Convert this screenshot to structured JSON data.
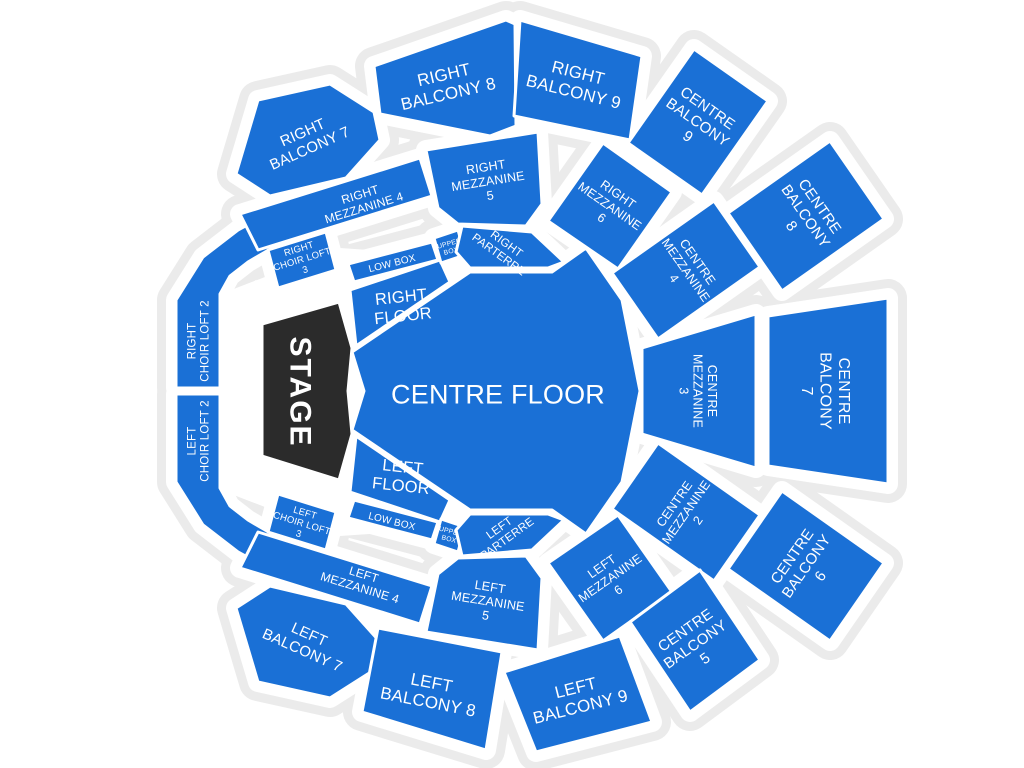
{
  "map": {
    "width": 1024,
    "height": 768,
    "background": "#ffffff",
    "outline_color": "#ebebeb",
    "gap_color": "#ffffff",
    "section_fill": "#1a70d6",
    "stage_fill": "#2b2b2b",
    "label_color": "#ffffff"
  },
  "spacers": [
    {
      "points": "226,292 340,248 458,256 458,528 340,536 226,492"
    }
  ],
  "sections": [
    {
      "id": "centre-floor",
      "kind": "seating",
      "label": [
        "CENTRE FLOOR"
      ],
      "points": "352,352 470,272 552,272 586,248 622,300 640,391 622,482 586,534 552,510 470,510 352,430 364,391",
      "label_x": 498,
      "label_y": 394,
      "label_rotate": 0,
      "font_size": 27
    },
    {
      "id": "right-floor",
      "kind": "seating",
      "label": [
        "RIGHT",
        "FLOOR"
      ],
      "points": "350,290 440,260 450,282 356,346",
      "label_x": 402,
      "label_y": 306,
      "label_rotate": -6,
      "font_size": 16.5
    },
    {
      "id": "left-floor",
      "kind": "seating",
      "label": [
        "LEFT",
        "FLOOR"
      ],
      "points": "350,492 440,522 450,500 356,436",
      "label_x": 402,
      "label_y": 476,
      "label_rotate": 6,
      "font_size": 16.5
    },
    {
      "id": "low-box-right",
      "kind": "seating",
      "label": [
        "LOW BOX"
      ],
      "points": "348,264 432,242 438,260 354,282",
      "label_x": 392,
      "label_y": 263,
      "label_rotate": -14,
      "font_size": 10
    },
    {
      "id": "low-box-left",
      "kind": "seating",
      "label": [
        "LOW BOX"
      ],
      "points": "348,518 432,540 438,522 354,500",
      "label_x": 392,
      "label_y": 521,
      "label_rotate": 14,
      "font_size": 10
    },
    {
      "id": "upper-box-right",
      "kind": "seating",
      "label": [
        "UPPER",
        "BOX"
      ],
      "points": "434,238 458,230 465,255 441,263",
      "label_x": 450,
      "label_y": 247,
      "label_rotate": -15,
      "font_size": 6.8
    },
    {
      "id": "upper-box-left",
      "kind": "seating",
      "label": [
        "UPPER",
        "BOX"
      ],
      "points": "434,544 458,552 465,527 441,519",
      "label_x": 450,
      "label_y": 535,
      "label_rotate": 15,
      "font_size": 6.8
    },
    {
      "id": "right-parterre",
      "kind": "seating",
      "label": [
        "RIGHT",
        "PARTERRE"
      ],
      "points": "462,226 532,232 564,262 548,268 470,268 456,252",
      "label_x": 503,
      "label_y": 249,
      "label_rotate": 36,
      "font_size": 11.5
    },
    {
      "id": "left-parterre",
      "kind": "seating",
      "label": [
        "LEFT",
        "PARTERRE"
      ],
      "points": "462,556 532,550 564,520 548,514 470,514 456,530",
      "label_x": 503,
      "label_y": 533,
      "label_rotate": -36,
      "font_size": 11.5
    },
    {
      "id": "right-choir-loft-2",
      "kind": "seating",
      "label": [
        "RIGHT",
        "CHOIR LOFT 2"
      ],
      "points": "176,300 203,257 238,230 264,216 272,248 248,262 230,276 220,294 220,388 176,388",
      "label_x": 198,
      "label_y": 341,
      "label_rotate": -90,
      "font_size": 11.5
    },
    {
      "id": "left-choir-loft-2",
      "kind": "seating",
      "label": [
        "LEFT",
        "CHOIR LOFT 2"
      ],
      "points": "176,482 203,525 238,552 264,566 272,534 248,520 230,506 220,488 220,394 176,394",
      "label_x": 198,
      "label_y": 441,
      "label_rotate": -90,
      "font_size": 11.5
    },
    {
      "id": "right-choir-loft-3",
      "kind": "seating",
      "label": [
        "RIGHT",
        "CHOIR LOFT",
        "3"
      ],
      "points": "268,250 326,232 336,270 278,288",
      "label_x": 302,
      "label_y": 259,
      "label_rotate": -17,
      "font_size": 9.5
    },
    {
      "id": "left-choir-loft-3",
      "kind": "seating",
      "label": [
        "LEFT",
        "CHOIR LOFT",
        "3"
      ],
      "points": "268,532 326,550 336,512 278,494",
      "label_x": 302,
      "label_y": 523,
      "label_rotate": 17,
      "font_size": 9.5
    },
    {
      "id": "right-mezzanine-4",
      "kind": "seating",
      "label": [
        "RIGHT",
        "MEZZANINE 4"
      ],
      "points": "240,214 420,158 432,196 258,250",
      "label_x": 362,
      "label_y": 201,
      "label_rotate": -17,
      "font_size": 12
    },
    {
      "id": "left-mezzanine-4",
      "kind": "seating",
      "label": [
        "LEFT",
        "MEZZANINE 4"
      ],
      "points": "240,568 420,624 432,586 258,532",
      "label_x": 362,
      "label_y": 581,
      "label_rotate": 17,
      "font_size": 12
    },
    {
      "id": "right-mezzanine-5",
      "kind": "seating",
      "label": [
        "RIGHT",
        "MEZZANINE",
        "5"
      ],
      "points": "426,150 538,132 542,204 526,226 458,224 438,208",
      "label_x": 488,
      "label_y": 181,
      "label_rotate": -9,
      "font_size": 12.5
    },
    {
      "id": "left-mezzanine-5",
      "kind": "seating",
      "label": [
        "LEFT",
        "MEZZANINE",
        "5"
      ],
      "points": "426,632 538,650 542,578 526,556 458,558 438,574",
      "label_x": 488,
      "label_y": 601,
      "label_rotate": 9,
      "font_size": 12.5
    },
    {
      "id": "right-mezzanine-6",
      "kind": "seating",
      "label": [
        "RIGHT",
        "MEZZANINE",
        "6"
      ],
      "points": "672,192 618,269 548,221 603,143",
      "label_x": 610,
      "label_y": 206,
      "label_rotate": 35,
      "font_size": 12.5
    },
    {
      "id": "left-mezzanine-6",
      "kind": "seating",
      "label": [
        "LEFT",
        "MEZZANINE",
        "6"
      ],
      "points": "672,592 618,515 548,563 603,641",
      "label_x": 610,
      "label_y": 578,
      "label_rotate": -35,
      "font_size": 12.5
    },
    {
      "id": "centre-mezzanine-4",
      "kind": "seating",
      "label": [
        "CENTRE",
        "MEZZANINE",
        "4"
      ],
      "points": "760,267 658,339 612,273 714,201",
      "label_x": 686,
      "label_y": 270,
      "label_rotate": 55,
      "font_size": 12.5
    },
    {
      "id": "centre-mezzanine-3",
      "kind": "seating",
      "label": [
        "CENTRE",
        "MEZZANINE",
        "3"
      ],
      "points": "642,348 756,314 756,468 642,434",
      "label_x": 698,
      "label_y": 391,
      "label_rotate": 90,
      "font_size": 12.5
    },
    {
      "id": "centre-mezzanine-2",
      "kind": "seating",
      "label": [
        "CENTRE",
        "MEZZANINE",
        "2"
      ],
      "points": "760,515 658,443 612,509 714,581",
      "label_x": 686,
      "label_y": 512,
      "label_rotate": -55,
      "font_size": 12.5
    },
    {
      "id": "right-balcony-7",
      "kind": "seating",
      "label": [
        "RIGHT",
        "BALCONY 7"
      ],
      "points": "236,174 258,100 330,84 374,112 380,140 346,178 270,196",
      "label_x": 306,
      "label_y": 140,
      "label_rotate": -24,
      "font_size": 15
    },
    {
      "id": "left-balcony-7",
      "kind": "seating",
      "label": [
        "LEFT",
        "BALCONY 7"
      ],
      "points": "236,608 258,682 330,698 374,670 380,642 346,604 270,586",
      "label_x": 306,
      "label_y": 642,
      "label_rotate": 24,
      "font_size": 15
    },
    {
      "id": "right-balcony-8",
      "kind": "seating",
      "label": [
        "RIGHT",
        "BALCONY 8"
      ],
      "points": "374,66 506,20 515,24 516,126 490,136 380,114",
      "label_x": 446,
      "label_y": 84,
      "label_rotate": -13,
      "font_size": 17
    },
    {
      "id": "left-balcony-8",
      "kind": "seating",
      "label": [
        "LEFT",
        "BALCONY 8"
      ],
      "points": "362,712 378,628 502,652 486,750",
      "label_x": 430,
      "label_y": 692,
      "label_rotate": 11,
      "font_size": 17
    },
    {
      "id": "right-balcony-9",
      "kind": "seating",
      "label": [
        "RIGHT",
        "BALCONY 9"
      ],
      "points": "520,20 642,56 630,140 514,116",
      "label_x": 576,
      "label_y": 82,
      "label_rotate": 14,
      "font_size": 17
    },
    {
      "id": "left-balcony-9",
      "kind": "seating",
      "label": [
        "LEFT",
        "BALCONY 9"
      ],
      "points": "504,672 620,636 652,722 536,752",
      "label_x": 578,
      "label_y": 697,
      "label_rotate": -14,
      "font_size": 17
    },
    {
      "id": "centre-balcony-9",
      "kind": "seating",
      "label": [
        "CENTRE",
        "BALCONY",
        "9"
      ],
      "points": "768,101 702,195 628,143 694,49",
      "label_x": 698,
      "label_y": 122,
      "label_rotate": 35,
      "font_size": 15
    },
    {
      "id": "centre-balcony-8",
      "kind": "seating",
      "label": [
        "CENTRE",
        "BALCONY",
        "8"
      ],
      "points": "884,219 782,291 728,213 830,141",
      "label_x": 806,
      "label_y": 216,
      "label_rotate": 55,
      "font_size": 15
    },
    {
      "id": "centre-balcony-7",
      "kind": "seating",
      "label": [
        "CENTRE",
        "BALCONY",
        "7"
      ],
      "points": "768,316 888,298 888,484 768,466",
      "label_x": 826,
      "label_y": 391,
      "label_rotate": 90,
      "font_size": 16
    },
    {
      "id": "centre-balcony-6",
      "kind": "seating",
      "label": [
        "CENTRE",
        "BALCONY",
        "6"
      ],
      "points": "884,563 782,491 728,569 830,641",
      "label_x": 806,
      "label_y": 566,
      "label_rotate": -55,
      "font_size": 15
    },
    {
      "id": "centre-balcony-5",
      "kind": "seating",
      "label": [
        "CENTRE",
        "BALCONY",
        "5"
      ],
      "points": "760,660 700,570 630,622 690,712",
      "label_x": 695,
      "label_y": 644,
      "label_rotate": -35,
      "font_size": 15
    },
    {
      "id": "stage",
      "kind": "stage",
      "label": [
        "STAGE"
      ],
      "points": "262,324 339,302 352,348 348,391 352,434 339,480 262,456",
      "label_x": 301,
      "label_y": 392,
      "label_rotate": 90,
      "font_size": 30,
      "bold": true,
      "letter_spacing": 2
    }
  ]
}
